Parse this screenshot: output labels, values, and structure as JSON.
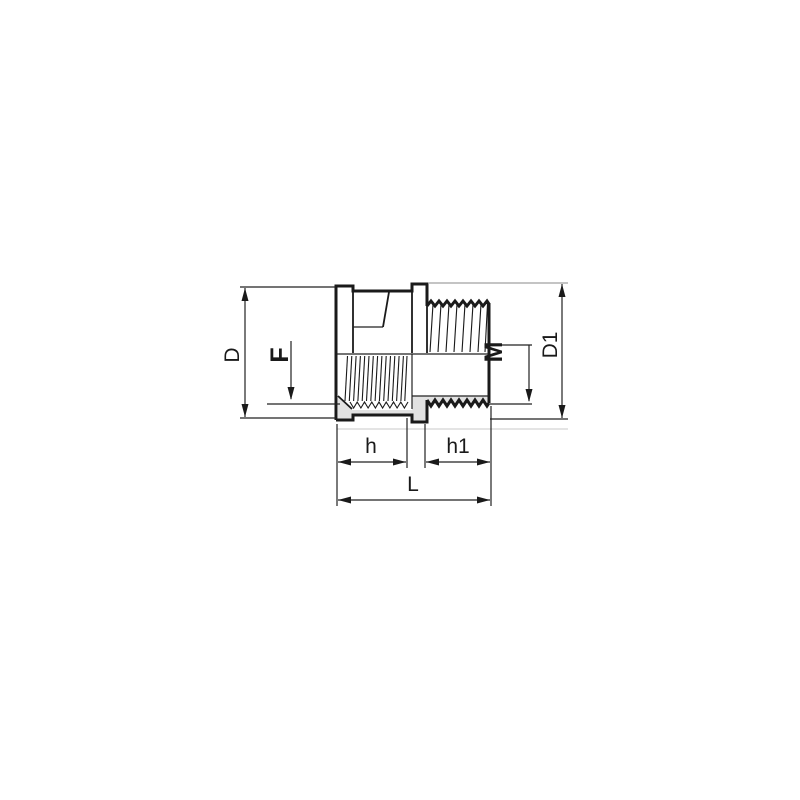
{
  "drawing": {
    "labels": {
      "D": "D",
      "F": "F",
      "M": "M",
      "D1": "D1",
      "h": "h",
      "h1": "h1",
      "L": "L"
    },
    "colors": {
      "line": "#1a1a1a",
      "section_fill": "#e2e2e2",
      "extension_line": "#a0a0a0",
      "background": "#ffffff"
    }
  }
}
